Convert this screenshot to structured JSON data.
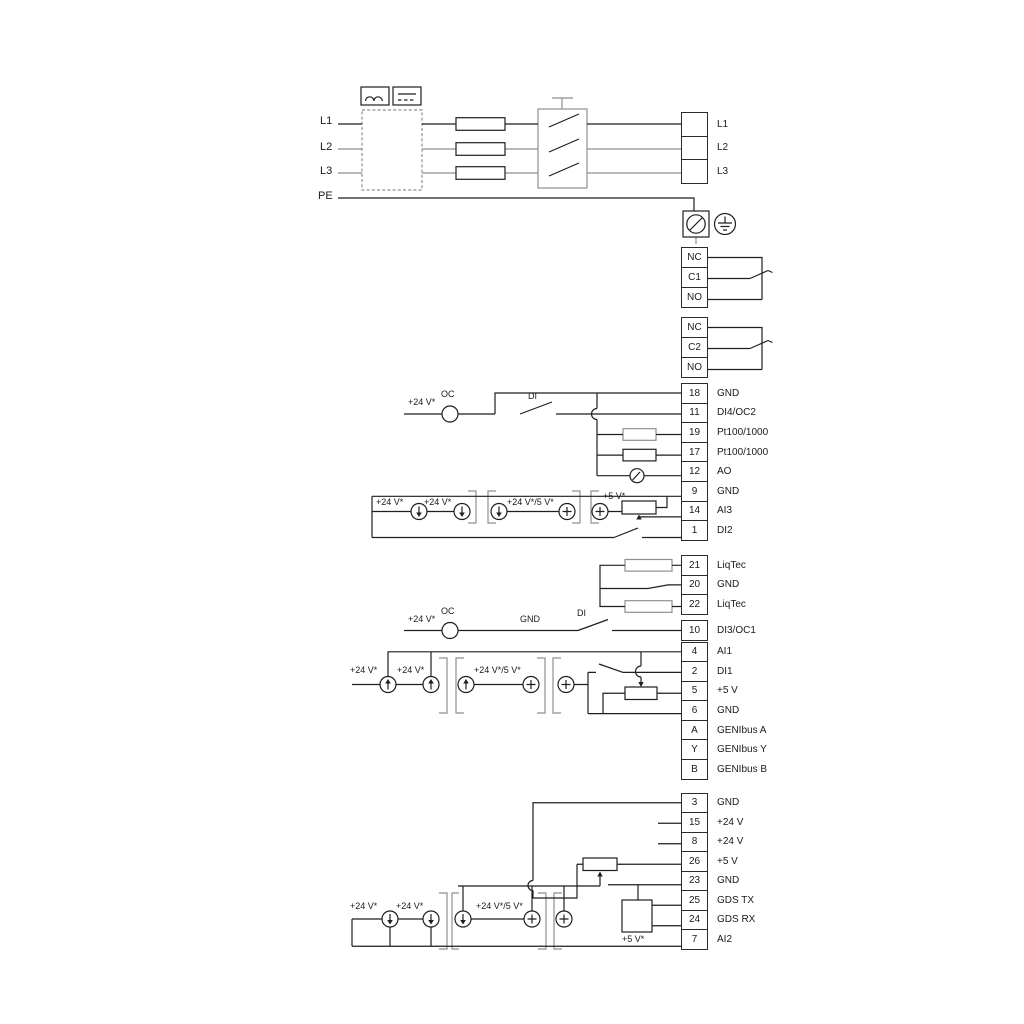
{
  "power_section": {
    "input_labels": [
      {
        "text": "L1"
      },
      {
        "text": "L2"
      },
      {
        "text": "L3"
      },
      {
        "text": "PE"
      }
    ],
    "output_terminals": [
      {
        "text": "L1"
      },
      {
        "text": "L2"
      },
      {
        "text": "L3"
      }
    ]
  },
  "relay1": [
    {
      "text": "NC"
    },
    {
      "text": "C1"
    },
    {
      "text": "NO"
    }
  ],
  "relay2": [
    {
      "text": "NC"
    },
    {
      "text": "C2"
    },
    {
      "text": "NO"
    }
  ],
  "io_block1": [
    {
      "num": "18",
      "label": "GND"
    },
    {
      "num": "11",
      "label": "DI4/OC2"
    },
    {
      "num": "19",
      "label": "Pt100/1000"
    },
    {
      "num": "17",
      "label": "Pt100/1000"
    },
    {
      "num": "12",
      "label": "AO"
    },
    {
      "num": "9",
      "label": "GND"
    },
    {
      "num": "14",
      "label": "AI3"
    },
    {
      "num": "1",
      "label": "DI2"
    }
  ],
  "liqtec_block": [
    {
      "num": "21",
      "label": "LiqTec"
    },
    {
      "num": "20",
      "label": "GND"
    },
    {
      "num": "22",
      "label": "LiqTec"
    }
  ],
  "di3_block": [
    {
      "num": "10",
      "label": "DI3/OC1"
    }
  ],
  "io_block2": [
    {
      "num": "4",
      "label": "AI1"
    },
    {
      "num": "2",
      "label": "DI1"
    },
    {
      "num": "5",
      "label": "+5 V"
    },
    {
      "num": "6",
      "label": "GND"
    },
    {
      "num": "A",
      "label": "GENIbus A"
    },
    {
      "num": "Y",
      "label": "GENIbus Y"
    },
    {
      "num": "B",
      "label": "GENIbus B"
    }
  ],
  "io_block3": [
    {
      "num": "3",
      "label": "GND"
    },
    {
      "num": "15",
      "label": "+24 V"
    },
    {
      "num": "8",
      "label": "+24 V"
    },
    {
      "num": "26",
      "label": "+5 V"
    },
    {
      "num": "23",
      "label": "GND"
    },
    {
      "num": "25",
      "label": "GDS TX"
    },
    {
      "num": "24",
      "label": "GDS RX"
    },
    {
      "num": "7",
      "label": "AI2"
    }
  ],
  "wire_labels": {
    "row_di4": {
      "v24": "+24 V*",
      "oc": "OC",
      "di": "DI"
    },
    "row_ai3": {
      "v24_a": "+24 V*",
      "v24_b": "+24 V*",
      "v24_5v": "+24 V*/5 V*",
      "v5": "+5 V*"
    },
    "row_di3": {
      "v24": "+24 V*",
      "oc": "OC",
      "gnd": "GND",
      "di": "DI"
    },
    "row_ai1": {
      "v24_a": "+24 V*",
      "v24_b": "+24 V*",
      "v24_5v": "+24 V*/5 V*"
    },
    "row_ai2": {
      "v24_a": "+24 V*",
      "v24_b": "+24 V*",
      "v24_5v": "+24 V*/5 V*",
      "v5": "+5 V*"
    }
  },
  "colors": {
    "line": "#1f1f1f",
    "gray": "#8f8f8f",
    "background": "#ffffff"
  }
}
